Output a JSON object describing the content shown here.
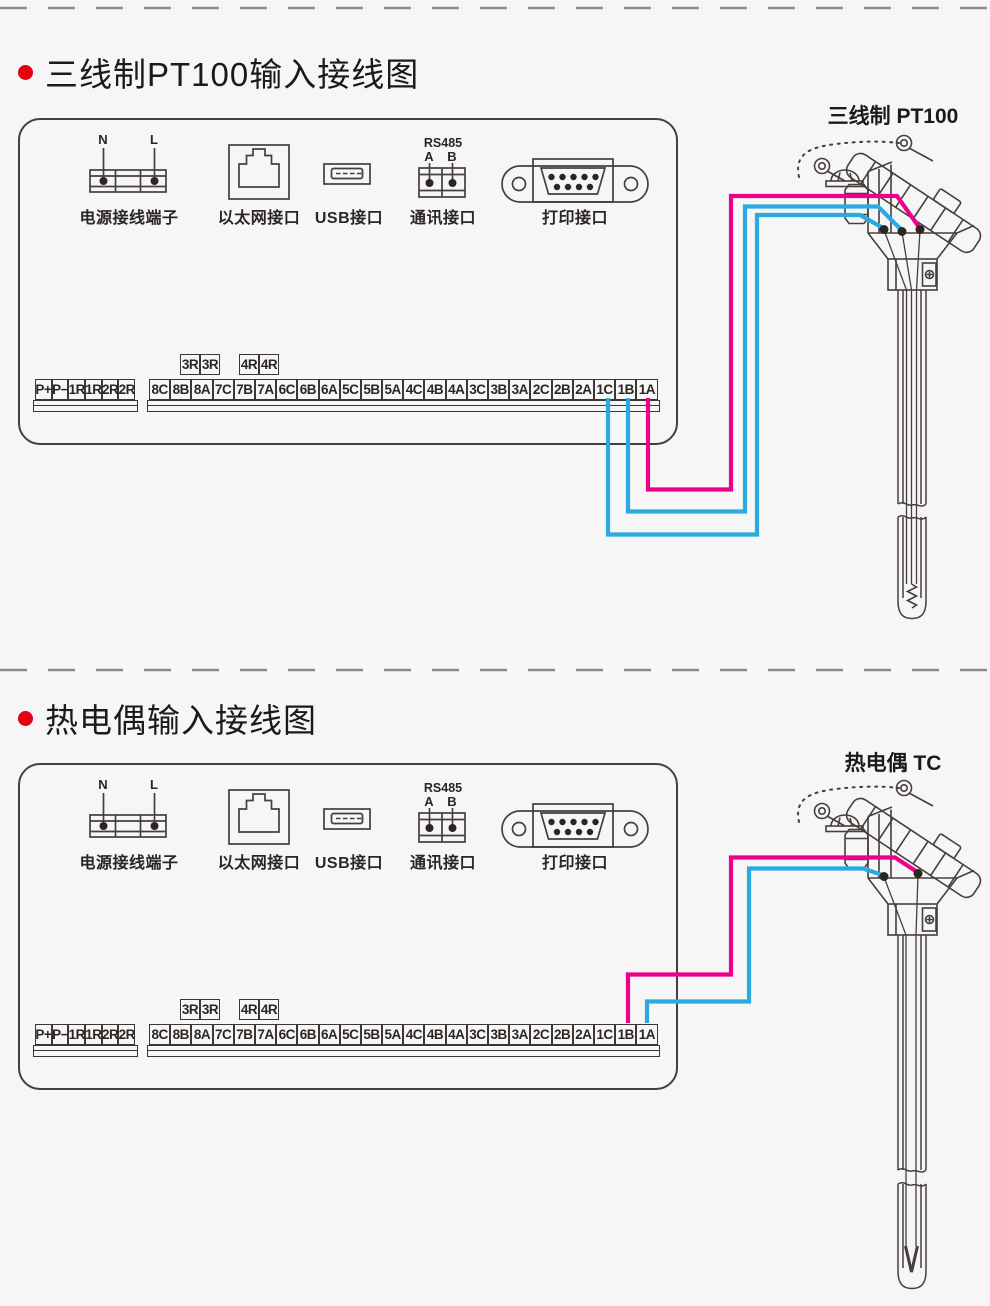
{
  "sections": [
    {
      "title": "三线制PT100输入接线图",
      "sensor_label": "三线制 PT100"
    },
    {
      "title": "热电偶输入接线图",
      "sensor_label": "热电偶 TC"
    }
  ],
  "panel": {
    "power": {
      "label": "电源接线端子",
      "pin_n": "N",
      "pin_l": "L"
    },
    "ethernet": {
      "label": "以太网接口"
    },
    "usb": {
      "label": "USB接口"
    },
    "comm": {
      "label": "通讯接口",
      "bus": "RS485",
      "pin_a": "A",
      "pin_b": "B"
    },
    "printer": {
      "label": "打印接口"
    },
    "aux_left": [
      "3R",
      "3R"
    ],
    "aux_right": [
      "4R",
      "4R"
    ],
    "left_terminals": [
      "P+",
      "P−",
      "1R",
      "1R",
      "2R",
      "2R"
    ],
    "main_terminals": [
      "8C",
      "8B",
      "8A",
      "7C",
      "7B",
      "7A",
      "6C",
      "6B",
      "6A",
      "5C",
      "5B",
      "5A",
      "4C",
      "4B",
      "4A",
      "3C",
      "3B",
      "3A",
      "2C",
      "2B",
      "2A",
      "1C",
      "1B",
      "1A"
    ]
  },
  "colors": {
    "wire_pink": "#ec008c",
    "wire_blue": "#29abe2",
    "line_art": "#463f3b",
    "bullet_red": "#e60012",
    "dash_gray": "#8c8c8c"
  }
}
